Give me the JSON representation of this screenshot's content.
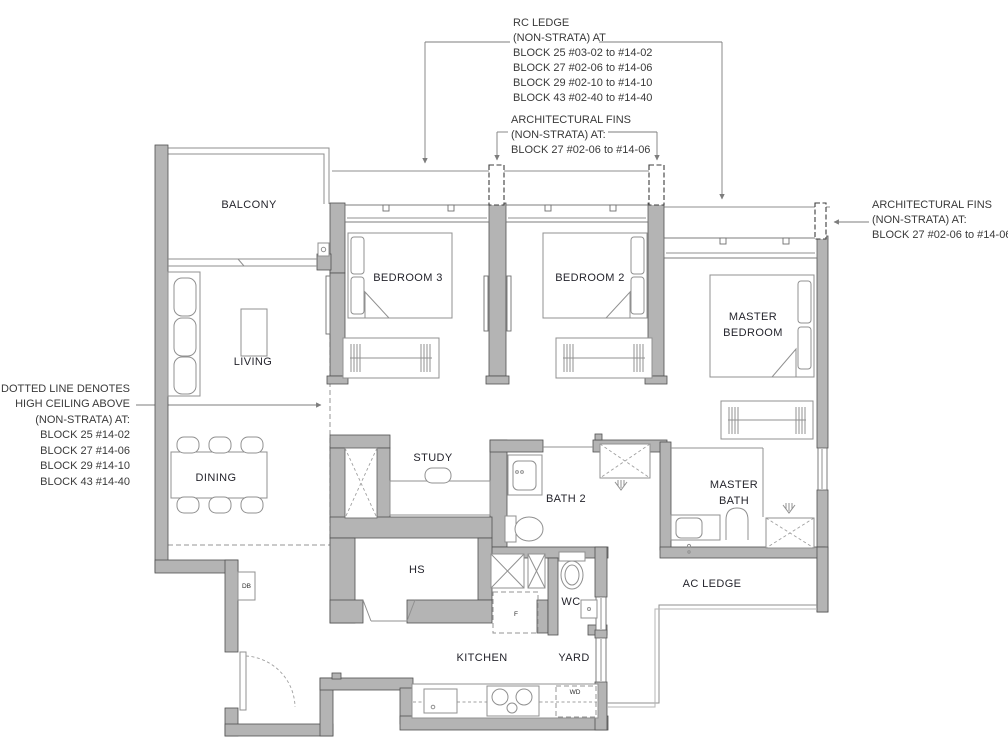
{
  "palette": {
    "wall_fill": "#b4b4b4",
    "wall_stroke": "#505050",
    "line_gray": "#8f8f8f",
    "text_color": "#24242c",
    "background": "#ffffff"
  },
  "annotations": {
    "rc_ledge": {
      "lines": [
        "RC LEDGE",
        "(NON-STRATA) AT",
        "BLOCK 25 #03-02 to #14-02",
        "BLOCK 27 #02-06 to #14-06",
        "BLOCK 29 #02-10 to #14-10",
        "BLOCK 43 #02-40 to #14-40"
      ]
    },
    "arch_fins_top": {
      "lines": [
        "ARCHITECTURAL FINS",
        "(NON-STRATA) AT:",
        "BLOCK 27 #02-06 to #14-06"
      ]
    },
    "arch_fins_right": {
      "lines": [
        "ARCHITECTURAL FINS",
        "(NON-STRATA) AT:",
        "BLOCK 27 #02-06 to #14-06"
      ]
    },
    "high_ceiling": {
      "lines": [
        "DOTTED LINE DENOTES",
        "HIGH CEILING ABOVE",
        "(NON-STRATA) AT:",
        "BLOCK 25 #14-02",
        "BLOCK 27 #14-06",
        "BLOCK 29 #14-10",
        "BLOCK 43 #14-40"
      ]
    }
  },
  "rooms": {
    "balcony": "BALCONY",
    "living": "LIVING",
    "dining": "DINING",
    "bedroom3": "BEDROOM 3",
    "bedroom2": "BEDROOM 2",
    "master_bedroom_l1": "MASTER",
    "master_bedroom_l2": "BEDROOM",
    "study": "STUDY",
    "bath2": "BATH 2",
    "master_bath_l1": "MASTER",
    "master_bath_l2": "BATH",
    "hs": "HS",
    "wc": "WC",
    "kitchen": "KITCHEN",
    "yard": "YARD",
    "ac_ledge": "AC LEDGE"
  },
  "equipment": {
    "db": "DB",
    "fridge": "F",
    "washer_dryer": "WD"
  }
}
